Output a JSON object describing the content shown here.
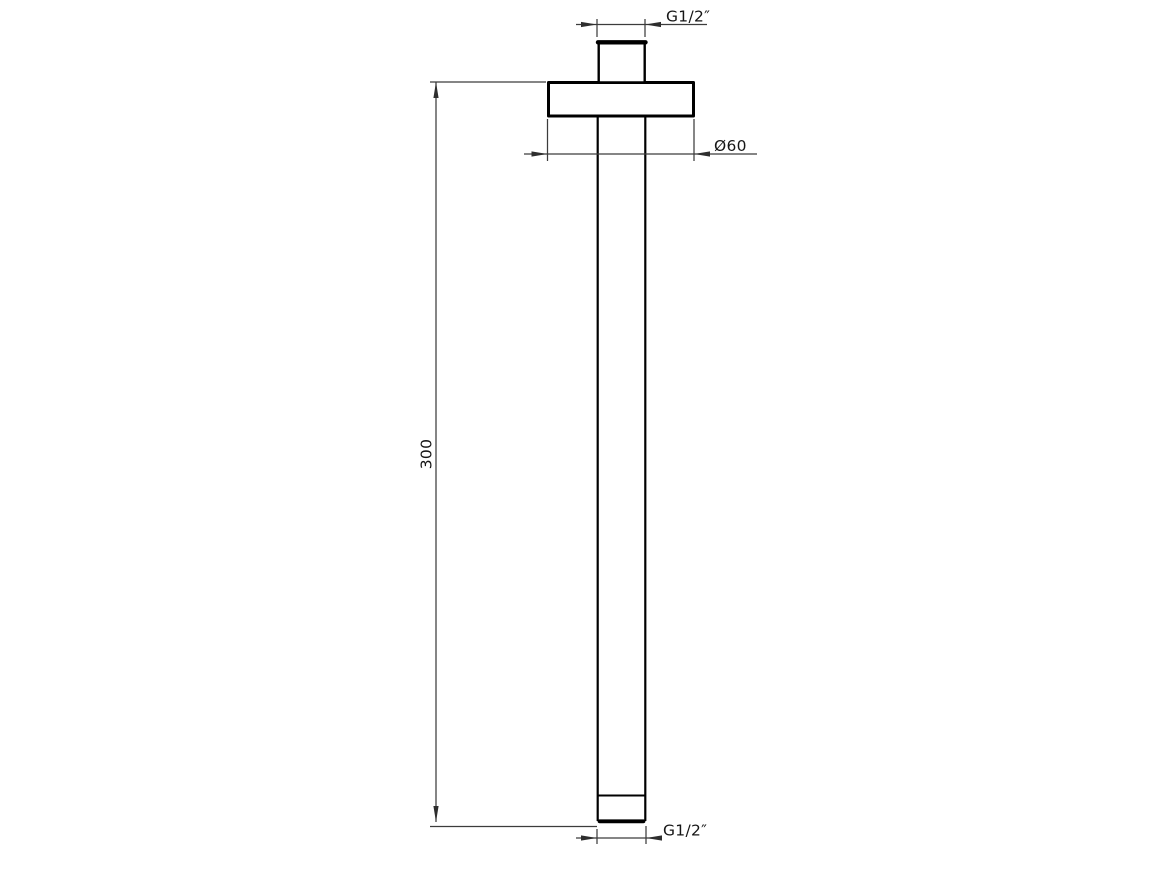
{
  "drawing": {
    "type": "technical-dimension-drawing",
    "labels": {
      "top_thread": "G1/2″",
      "flange_diameter": "Ø60",
      "arm_length": "300",
      "bottom_thread": "G1/2″"
    },
    "colors": {
      "background": "#ffffff",
      "object_line": "#000000",
      "dimension_line": "#3c3c3c",
      "text": "#161616"
    }
  }
}
